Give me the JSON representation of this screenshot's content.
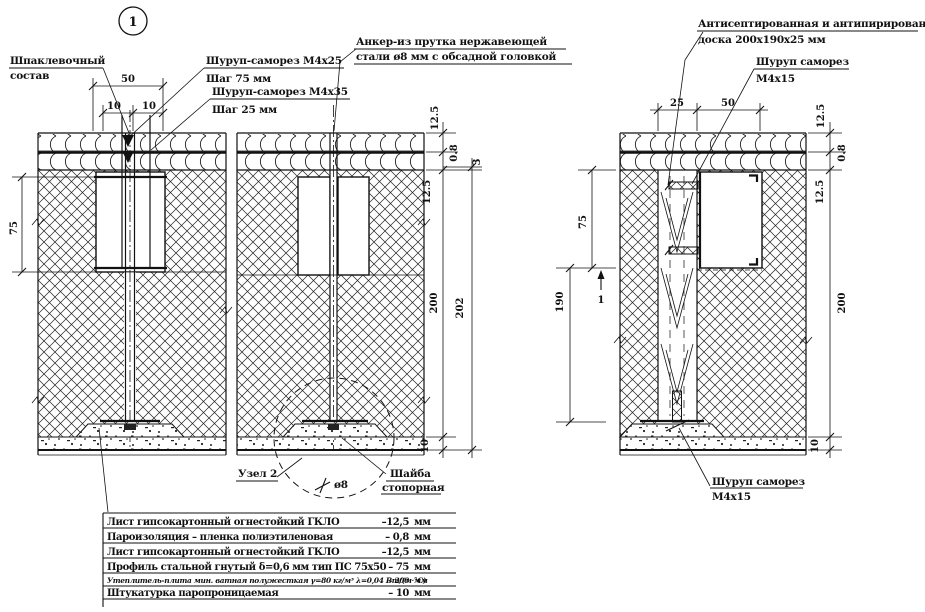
{
  "labels": {
    "bubble": "1",
    "putty1": "Шпаклевочный",
    "putty2": "состав",
    "screw25": "Шуруп-саморез М4х25",
    "screw25_step": "Шаг 75 мм",
    "screw35": "Шуруп-саморез М4х35",
    "screw35_step": "Шаг 25 мм",
    "anchor1": "Анкер-из прутка нержавеющей",
    "anchor2": "стали ø8 мм с обсадной головкой",
    "board1": "Антисептированная и антипирированная",
    "board2": "доска 200х190х25 мм",
    "screw15_top1": "Шуруп саморез",
    "screw15_top2": "М4х15",
    "screw15_bot1": "Шуруп саморез",
    "screw15_bot2": "М4х15",
    "node": "Узел 2",
    "washer1": "Шайба",
    "washer2": "стопорная",
    "dia": "ø8",
    "section": "1"
  },
  "dims_left": {
    "w50": "50",
    "w10a": "10",
    "w10b": "10",
    "h75": "75",
    "t1": "12.5",
    "t2": "0.8",
    "t3": "12.5",
    "t4": "200",
    "t5": "10",
    "total": "202",
    "gap": "3"
  },
  "dims_right": {
    "w25": "25",
    "w50": "50",
    "h75": "75",
    "h190": "190",
    "t1": "12.5",
    "t2": "0.8",
    "t3": "12.5",
    "t4": "200",
    "t5": "10"
  },
  "legend": {
    "rows": [
      {
        "name": "Лист гипсокартонный огнестойкий ГКЛО",
        "value": "–12,5",
        "unit": "мм"
      },
      {
        "name": "Пароизоляция – пленка полиэтиленовая",
        "value": "– 0,8",
        "unit": "мм"
      },
      {
        "name": "Лист гипсокартонный огнестойкий ГКЛО",
        "value": "–12,5",
        "unit": "мм"
      },
      {
        "name": "Профиль стальной гнутый δ=0,6 мм тип ПС 75х50",
        "value": "– 75",
        "unit": "мм"
      },
      {
        "name": "Утеплитель-плита мин. ватная полужесткая γ=80 кг/м³ λ=0,04 Вт/(м·°С)",
        "value": "– 200",
        "unit": "мм"
      },
      {
        "name": "Штукатурка паропроницаемая",
        "value": "– 10",
        "unit": "мм"
      }
    ]
  }
}
